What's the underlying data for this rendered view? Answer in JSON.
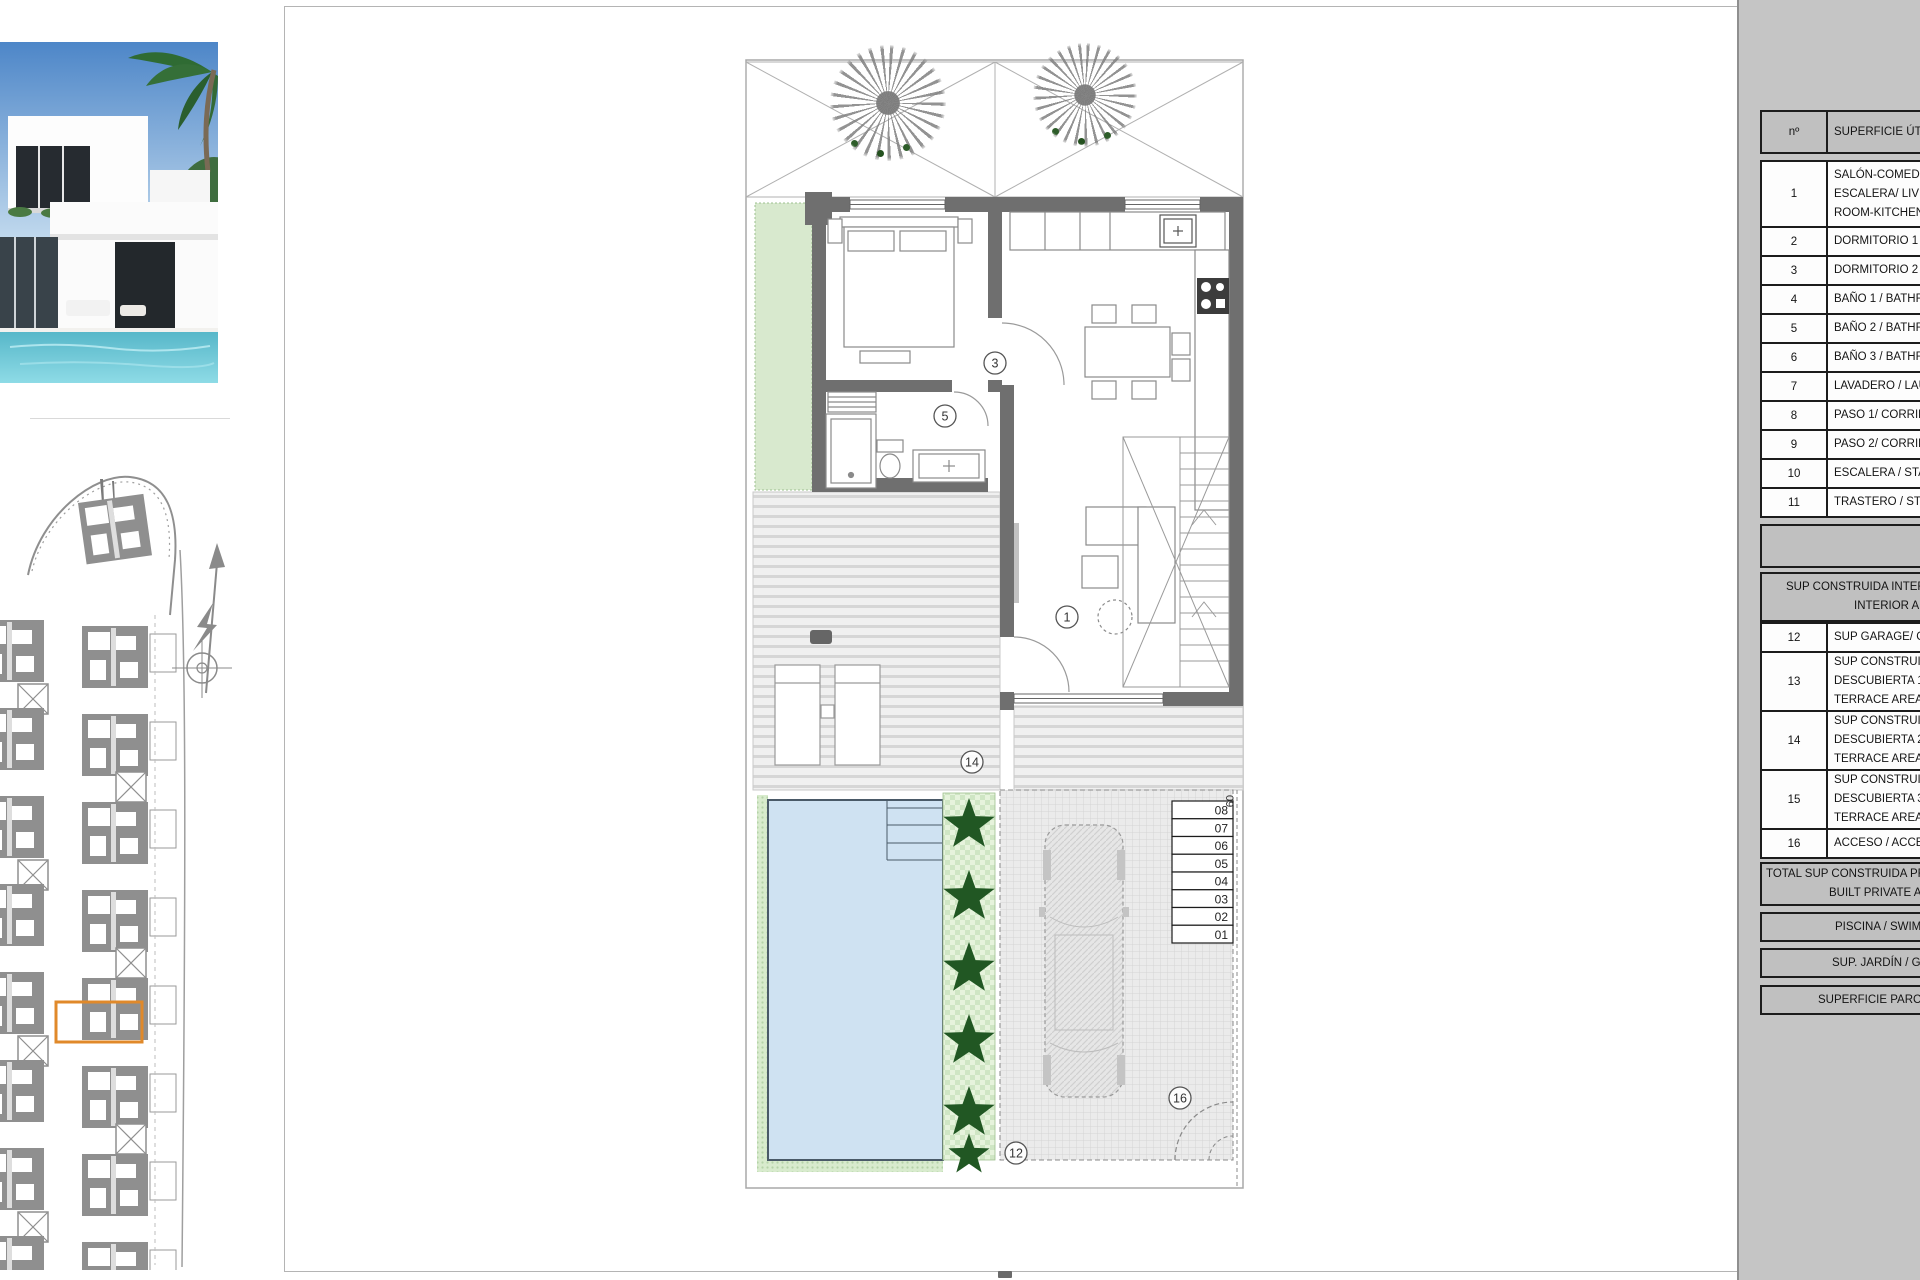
{
  "table": {
    "header": {
      "no": "nº",
      "area_label": "SUPERFICIE ÚTIL"
    },
    "rooms": [
      {
        "no": "1",
        "lines": [
          "SALÓN-COMEDOR-CO",
          "ESCALERA/ LIVING-DI",
          "ROOM-KITCHEN-STA"
        ]
      },
      {
        "no": "2",
        "lines": [
          "DORMITORIO 1 / BEDR"
        ]
      },
      {
        "no": "3",
        "lines": [
          "DORMITORIO 2 / BEDR"
        ]
      },
      {
        "no": "4",
        "lines": [
          "BAÑO 1 / BATHROOM"
        ]
      },
      {
        "no": "5",
        "lines": [
          "BAÑO 2 / BATHROOM"
        ]
      },
      {
        "no": "6",
        "lines": [
          "BAÑO 3 / BATHROOM"
        ]
      },
      {
        "no": "7",
        "lines": [
          "LAVADERO / LAUNDR"
        ]
      },
      {
        "no": "8",
        "lines": [
          "PASO 1/ CORRIDOR 1"
        ]
      },
      {
        "no": "9",
        "lines": [
          "PASO 2/ CORRIDOR 2"
        ]
      },
      {
        "no": "10",
        "lines": [
          "ESCALERA / STAIRS"
        ]
      },
      {
        "no": "11",
        "lines": [
          "TRASTERO / STORAG"
        ]
      }
    ],
    "interior_band": [
      "SUP CONSTRUIDA INTERIOR",
      "INTERIOR AREA"
    ],
    "exterior": [
      {
        "no": "12",
        "lines": [
          "SUP GARAGE/ GARAG"
        ]
      },
      {
        "no": "13",
        "lines": [
          "SUP CONSTRUIDA",
          "DESCUBIERTA 1 / OP",
          "TERRACE AREA 1"
        ]
      },
      {
        "no": "14",
        "lines": [
          "SUP CONSTRUIDA",
          "DESCUBIERTA 2 / OP",
          "TERRACE AREA 2"
        ]
      },
      {
        "no": "15",
        "lines": [
          "SUP CONSTRUIDA",
          "DESCUBIERTA 3 / OP",
          "TERRACE AREA 3"
        ]
      },
      {
        "no": "16",
        "lines": [
          "ACCESO / ACCESS"
        ]
      }
    ],
    "total_band": [
      "TOTAL SUP CONSTRUIDA PRIVA",
      "BUILT PRIVATE AR"
    ],
    "pool_band": "PISCINA / SWIMMING",
    "garden_band": "SUP. JARDÍN / GARDEN",
    "plot_band": "SUPERFICIE PARCELA / P"
  },
  "plan": {
    "room_labels": [
      "1",
      "3",
      "5",
      "12",
      "14",
      "16"
    ],
    "steps": [
      "08",
      "07",
      "06",
      "05",
      "04",
      "03",
      "02",
      "01"
    ],
    "steps_side": "09"
  },
  "colors": {
    "highlight_orange": "#e0892a",
    "site_gray": "#8f8f8f",
    "wall_gray": "#6f6f6f",
    "pool_blue": "#cfe2f2",
    "garden_green": "#d8e9ce",
    "hedge_green": "#215723",
    "panel_gray": "#c5c5c5"
  }
}
